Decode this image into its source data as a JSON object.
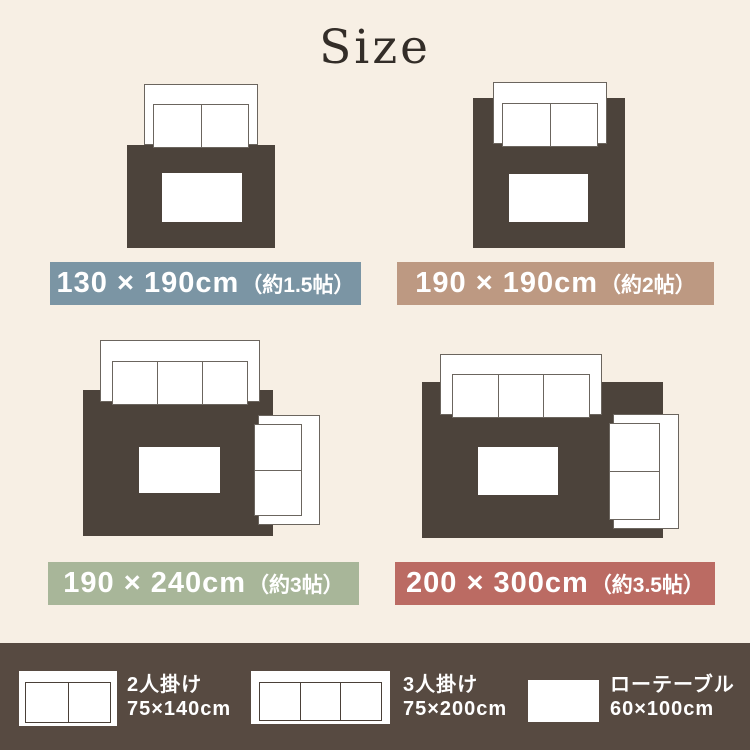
{
  "title": "Size",
  "colors": {
    "background": "#F7EFE4",
    "rug": "#4C433B",
    "legend_bar": "#574A41",
    "label_blue": "#7B95A4",
    "label_tan": "#BD9982",
    "label_green": "#A8B699",
    "label_red": "#BB6B63"
  },
  "sizes": [
    {
      "label": "130 × 190cm",
      "note": "（約1.5帖）",
      "color": "#7B95A4"
    },
    {
      "label": "190 × 190cm",
      "note": "（約2帖）",
      "color": "#BD9982"
    },
    {
      "label": "190 × 240cm",
      "note": "（約3帖）",
      "color": "#A8B699"
    },
    {
      "label": "200 × 300cm",
      "note": "（約3.5帖）",
      "color": "#BB6B63"
    }
  ],
  "legend": {
    "items": [
      {
        "name": "2人掛け",
        "size": "75×140cm"
      },
      {
        "name": "3人掛け",
        "size": "75×200cm"
      },
      {
        "name": "ローテーブル",
        "size": "60×100cm"
      }
    ]
  }
}
